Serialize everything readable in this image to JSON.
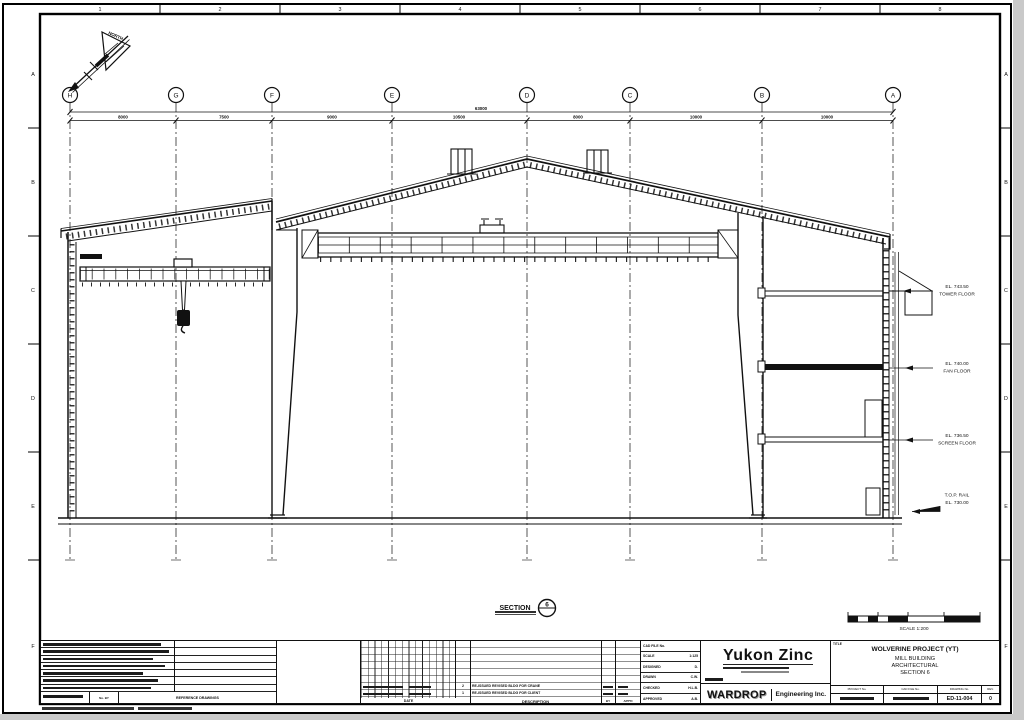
{
  "sheet": {
    "top_numbers": [
      "1",
      "2",
      "3",
      "4",
      "5",
      "6",
      "7",
      "8"
    ],
    "side_letters": [
      "A",
      "B",
      "C",
      "D",
      "E",
      "F"
    ]
  },
  "grid": {
    "bubbles": [
      "H",
      "G",
      "F",
      "E",
      "D",
      "C",
      "B",
      "A"
    ]
  },
  "dims": {
    "total": "63000",
    "spans": [
      "8000",
      "7500",
      "9000",
      "10500",
      "8000",
      "10000",
      "10000"
    ]
  },
  "north_arrow": {
    "label": "NORTH"
  },
  "callouts": [
    {
      "line1": "EL. 743.50",
      "line2": "TOWER FLOOR"
    },
    {
      "line1": "EL. 740.00",
      "line2": "FAN FLOOR"
    },
    {
      "line1": "EL. 736.50",
      "line2": "SCREEN FLOOR"
    },
    {
      "line1": "T.O.P. RAIL",
      "line2": "EL. 730.00"
    }
  ],
  "section_marker": {
    "label": "SECTION",
    "number": "6"
  },
  "scale_bar": {
    "label": "SCALE 1:200"
  },
  "title_block": {
    "notes": {
      "no_by": "No.  BY",
      "reference": "REFERENCE DRAWINGS"
    },
    "rev": {
      "date_header": "DATE",
      "desc_header": "DESCRIPTION",
      "by_header": "BY",
      "appd_header": "APP'D",
      "rows": [
        {
          "no": "2",
          "desc": "RE-ISSUED REVISED BLDG FOR CRANE"
        },
        {
          "no": "1",
          "desc": "RE-ISSUED REVISED BLDG FOR CLIENT"
        }
      ]
    },
    "info": {
      "rows": [
        {
          "label": "CAD FILE No.",
          "value": ""
        },
        {
          "label": "SCALE",
          "value": "1:125"
        },
        {
          "label": "DESIGNED",
          "value": "D."
        },
        {
          "label": "DRAWN",
          "value": "C.W."
        },
        {
          "label": "CHECKED",
          "value": "H.L.B."
        },
        {
          "label": "APPROVED",
          "value": "A.B."
        }
      ]
    },
    "logo": {
      "company": "Yukon Zinc",
      "firm": "WARDROP",
      "firm_suffix": "Engineering Inc."
    },
    "title": {
      "label": "TITLE",
      "project": "WOLVERINE PROJECT (YT)",
      "line1": "MILL BUILDING",
      "line2": "ARCHITECTURAL",
      "line3": "SECTION 6"
    },
    "numbers": {
      "headers": [
        "PROJECT No.",
        "CAD FILE No.",
        "DRAWING No.",
        "REV."
      ],
      "drawing_no": "ED-11-004",
      "rev": "0"
    }
  }
}
